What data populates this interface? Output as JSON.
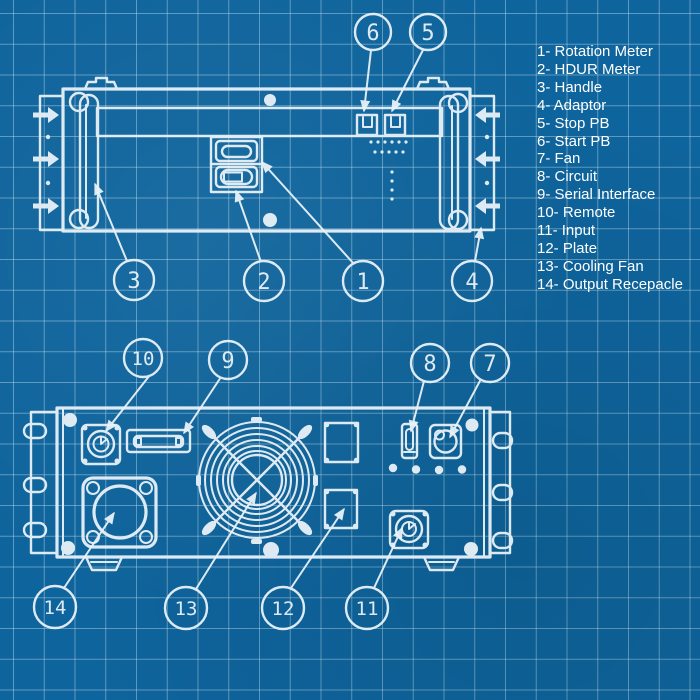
{
  "legend": {
    "items": [
      {
        "label": "1- Rotation Meter"
      },
      {
        "label": "2- HDUR Meter"
      },
      {
        "label": "3- Handle"
      },
      {
        "label": "4- Adaptor"
      },
      {
        "label": "5- Stop PB"
      },
      {
        "label": "6- Start PB"
      },
      {
        "label": "7- Fan"
      },
      {
        "label": "8- Circuit"
      },
      {
        "label": "9- Serial Interface"
      },
      {
        "label": "10- Remote"
      },
      {
        "label": "11- Input"
      },
      {
        "label": "12- Plate"
      },
      {
        "label": "13- Cooling Fan"
      },
      {
        "label": "14- Output Recepacle"
      }
    ]
  },
  "front_view": {
    "callouts": [
      {
        "number": "6",
        "part": "Start PB"
      },
      {
        "number": "5",
        "part": "Stop PB"
      },
      {
        "number": "3",
        "part": "Handle"
      },
      {
        "number": "2",
        "part": "HDUR Meter"
      },
      {
        "number": "1",
        "part": "Rotation Meter"
      },
      {
        "number": "4",
        "part": "Adaptor"
      }
    ]
  },
  "rear_view": {
    "callouts": [
      {
        "number": "10",
        "part": "Remote"
      },
      {
        "number": "9",
        "part": "Serial Interface"
      },
      {
        "number": "8",
        "part": "Circuit"
      },
      {
        "number": "7",
        "part": "Fan"
      },
      {
        "number": "14",
        "part": "Output Recepacle"
      },
      {
        "number": "13",
        "part": "Cooling Fan"
      },
      {
        "number": "12",
        "part": "Plate"
      },
      {
        "number": "11",
        "part": "Input"
      }
    ]
  },
  "colors": {
    "background": "#0e649c",
    "grid": "#6290b2",
    "ink": "#e9f2f8",
    "text": "#ffffff"
  }
}
